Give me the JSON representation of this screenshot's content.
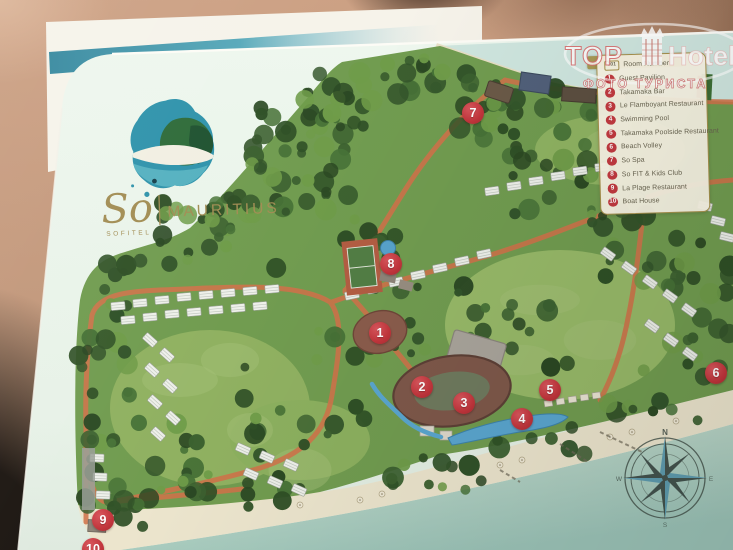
{
  "watermark": {
    "brand_top": "TOP",
    "brand_bottom": "Hotels",
    "subtitle": "ФОТО ТУРИСТА",
    "icon": "crowned-building-icon"
  },
  "logo": {
    "script": "So",
    "brand": "SOFITEL",
    "destination": "MAURITIUS"
  },
  "legend": {
    "room_row": {
      "badge": "101",
      "label": "Room Number"
    },
    "items": [
      {
        "num": "1",
        "label": "Guest Pavilion"
      },
      {
        "num": "2",
        "label": "Takamaka Bar"
      },
      {
        "num": "3",
        "label": "Le Flamboyant Restaurant"
      },
      {
        "num": "4",
        "label": "Swimming Pool"
      },
      {
        "num": "5",
        "label": "Takamaka Poolside Restaurant"
      },
      {
        "num": "6",
        "label": "Beach Volley"
      },
      {
        "num": "7",
        "label": "So Spa"
      },
      {
        "num": "8",
        "label": "So FIT & Kids Club"
      },
      {
        "num": "9",
        "label": "La Plage Restaurant"
      },
      {
        "num": "10",
        "label": "Boat House"
      }
    ]
  },
  "map_markers": [
    {
      "num": "1",
      "x": 380,
      "y": 333
    },
    {
      "num": "2",
      "x": 422,
      "y": 387
    },
    {
      "num": "3",
      "x": 464,
      "y": 403
    },
    {
      "num": "4",
      "x": 522,
      "y": 419
    },
    {
      "num": "5",
      "x": 550,
      "y": 390
    },
    {
      "num": "6",
      "x": 716,
      "y": 373
    },
    {
      "num": "7",
      "x": 473,
      "y": 113
    },
    {
      "num": "8",
      "x": 391,
      "y": 264
    },
    {
      "num": "9",
      "x": 103,
      "y": 520
    },
    {
      "num": "10",
      "x": 93,
      "y": 549
    }
  ],
  "compass": {
    "north": "N",
    "east": "E",
    "south": "S",
    "west": "W"
  },
  "colors": {
    "marker_red": "#c2353c",
    "legend_gold": "#a6914d",
    "card_mint": "#e9f4ea",
    "road_orange": "#d0734a",
    "forest_green": "#32512a",
    "lawn_green": "#93b365",
    "water_teal": "#a9cec2",
    "sand": "#ece5cd",
    "logo_gold": "#a28d54",
    "stripe_teal": "#3d8ea3"
  }
}
